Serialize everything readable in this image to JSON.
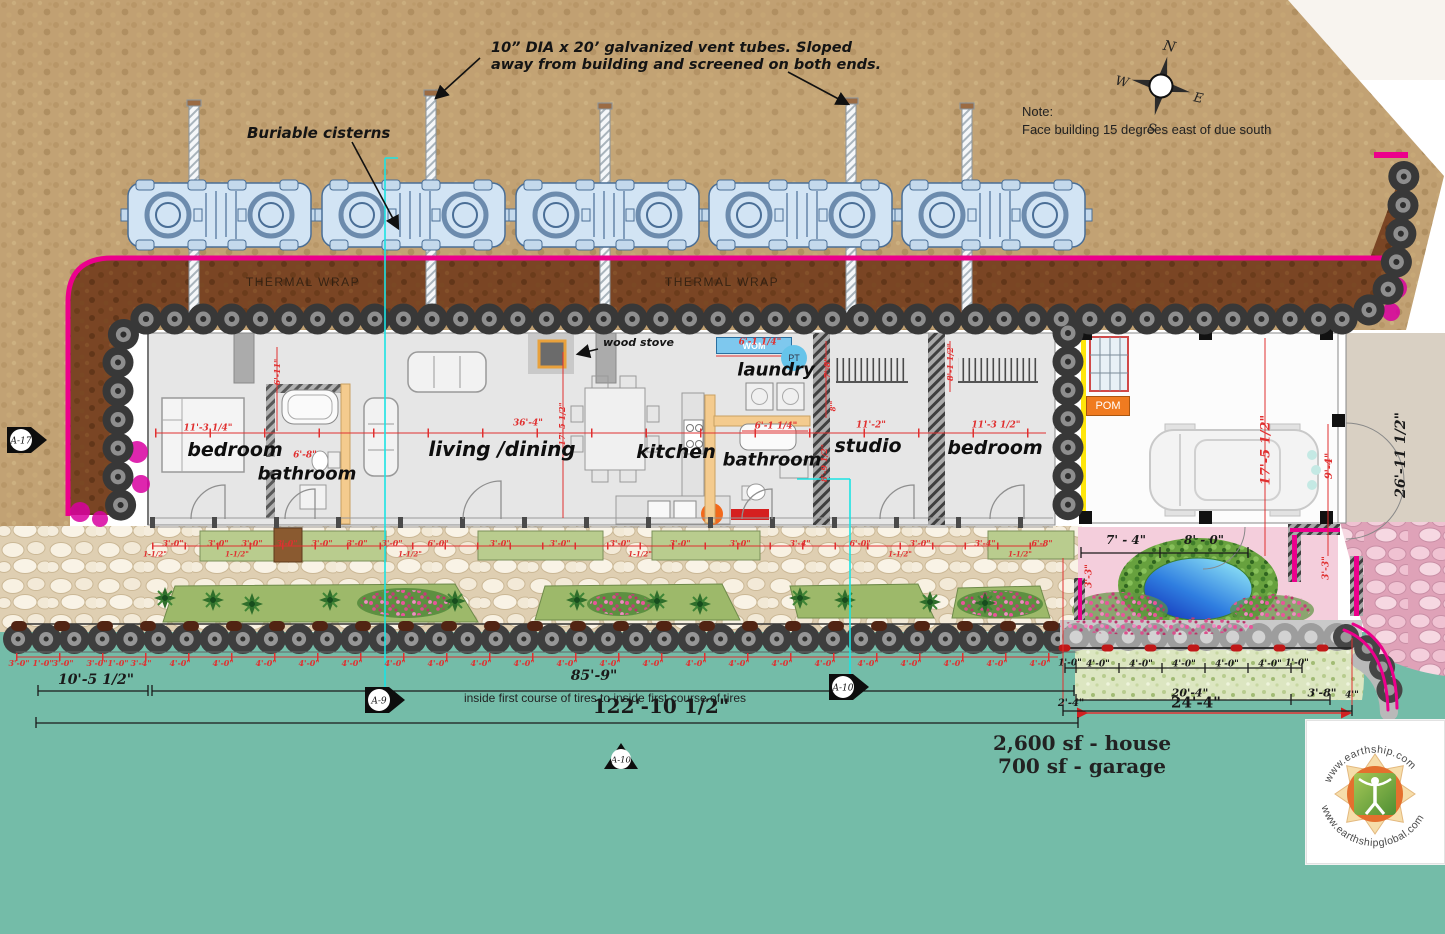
{
  "annotations": {
    "vent_note_1": "10” DIA x 20’ galvanized vent tubes. Sloped",
    "vent_note_2": "away from building and screened on both ends.",
    "buriable_cisterns": "Buriable cisterns",
    "note_title": "Note:",
    "note_body": "Face building 15 degrees east of due south",
    "thermal_wrap": "THERMAL WRAP",
    "wood_stove": "wood stove",
    "inside_tires": "inside first course of tires to inside first course of tires",
    "area_house": "2,600 sf - house",
    "area_garage": "700 sf - garage"
  },
  "compass": {
    "n": "N",
    "e": "E",
    "s": "S",
    "w": "W"
  },
  "equipment": {
    "wom": "WOM",
    "pt": "PT",
    "pom": "POM"
  },
  "logo": {
    "top": "www.earthship.com",
    "bottom": "www.earthshipglobal.com"
  },
  "markers": [
    {
      "t": "A-17"
    },
    {
      "t": "A-9"
    },
    {
      "t": "A-10"
    },
    {
      "t": "A-10"
    }
  ],
  "rooms": [
    {
      "t": "bedroom",
      "x": 235,
      "y": 450,
      "s": 19
    },
    {
      "t": "bathroom",
      "x": 307,
      "y": 474,
      "s": 18
    },
    {
      "t": "living /dining",
      "x": 502,
      "y": 449,
      "s": 20
    },
    {
      "t": "kitchen",
      "x": 676,
      "y": 452,
      "s": 19
    },
    {
      "t": "laundry",
      "x": 776,
      "y": 370,
      "s": 18
    },
    {
      "t": "bathroom",
      "x": 772,
      "y": 460,
      "s": 18
    },
    {
      "t": "studio",
      "x": 868,
      "y": 446,
      "s": 19
    },
    {
      "t": "bedroom",
      "x": 995,
      "y": 448,
      "s": 19
    }
  ],
  "dims_red": [
    {
      "t": "11'-3 1/4\"",
      "x": 208,
      "y": 429,
      "s": 9
    },
    {
      "t": "6'-11\"",
      "x": 277,
      "y": 372,
      "s": 8,
      "r": -90
    },
    {
      "t": "6'-8\"",
      "x": 305,
      "y": 456,
      "s": 9
    },
    {
      "t": "36'-4\"",
      "x": 528,
      "y": 424,
      "s": 9
    },
    {
      "t": "17'-5 1/2\"",
      "x": 562,
      "y": 424,
      "s": 8,
      "r": -90
    },
    {
      "t": "6'-1 1/4\"",
      "x": 760,
      "y": 343,
      "s": 9
    },
    {
      "t": "6'-1 1/4\"",
      "x": 776,
      "y": 427,
      "s": 9
    },
    {
      "t": "7'-8\"",
      "x": 827,
      "y": 368,
      "s": 8,
      "r": -90
    },
    {
      "t": "8'\"",
      "x": 833,
      "y": 406,
      "s": 7,
      "r": -90
    },
    {
      "t": "8'-9 1/2\"",
      "x": 824,
      "y": 463,
      "s": 8,
      "r": -90
    },
    {
      "t": "11'-2\"",
      "x": 871,
      "y": 426,
      "s": 9
    },
    {
      "t": "8'-1 1/2\"",
      "x": 950,
      "y": 362,
      "s": 8,
      "r": -90
    },
    {
      "t": "11'-3 1/2\"",
      "x": 996,
      "y": 426,
      "s": 9
    },
    {
      "t": "17'-5 1/2\"",
      "x": 1266,
      "y": 450,
      "s": 13,
      "r": -90
    },
    {
      "t": "9'-4\"",
      "x": 1330,
      "y": 466,
      "s": 10,
      "r": -90
    },
    {
      "t": "3'-3\"",
      "x": 1090,
      "y": 576,
      "s": 9,
      "r": -90
    },
    {
      "t": "3'-3\"",
      "x": 1327,
      "y": 568,
      "s": 9,
      "r": -90
    },
    {
      "t": "3'-0\"",
      "x": 173,
      "y": 543,
      "s": 8
    },
    {
      "t": "3'-0\"",
      "x": 218,
      "y": 543,
      "s": 8
    },
    {
      "t": "3'-0\"",
      "x": 252,
      "y": 543,
      "s": 8
    },
    {
      "t": "3'-0\"",
      "x": 287,
      "y": 543,
      "s": 8
    },
    {
      "t": "3'-0\"",
      "x": 322,
      "y": 543,
      "s": 8
    },
    {
      "t": "3'-0\"",
      "x": 357,
      "y": 543,
      "s": 8
    },
    {
      "t": "3'-0\"",
      "x": 392,
      "y": 543,
      "s": 8
    },
    {
      "t": "6'-0\"",
      "x": 438,
      "y": 543,
      "s": 8
    },
    {
      "t": "3'-0\"",
      "x": 500,
      "y": 543,
      "s": 8
    },
    {
      "t": "3'-0\"",
      "x": 560,
      "y": 543,
      "s": 8
    },
    {
      "t": "3'-0\"",
      "x": 620,
      "y": 543,
      "s": 8
    },
    {
      "t": "3'-0\"",
      "x": 680,
      "y": 543,
      "s": 8
    },
    {
      "t": "3'-0\"",
      "x": 740,
      "y": 543,
      "s": 8
    },
    {
      "t": "3'-4\"",
      "x": 800,
      "y": 543,
      "s": 8
    },
    {
      "t": "6'-0\"",
      "x": 860,
      "y": 543,
      "s": 8
    },
    {
      "t": "3'-0\"",
      "x": 920,
      "y": 543,
      "s": 8
    },
    {
      "t": "3'-4\"",
      "x": 985,
      "y": 543,
      "s": 8
    },
    {
      "t": "6'-8\"",
      "x": 1042,
      "y": 543,
      "s": 8
    },
    {
      "t": "1-1/2\"",
      "x": 155,
      "y": 554,
      "s": 7
    },
    {
      "t": "1-1/2\"",
      "x": 237,
      "y": 554,
      "s": 7
    },
    {
      "t": "1-1/2\"",
      "x": 410,
      "y": 554,
      "s": 7
    },
    {
      "t": "1-1/2\"",
      "x": 640,
      "y": 554,
      "s": 7
    },
    {
      "t": "1-1/2\"",
      "x": 900,
      "y": 554,
      "s": 7
    },
    {
      "t": "1-1/2\"",
      "x": 1020,
      "y": 554,
      "s": 7
    },
    {
      "t": "3'-0\"",
      "x": 19,
      "y": 663,
      "s": 8
    },
    {
      "t": "1'-0\"",
      "x": 43,
      "y": 663,
      "s": 8
    },
    {
      "t": "3'-0\"",
      "x": 63,
      "y": 663,
      "s": 8
    },
    {
      "t": "3'-0\"",
      "x": 97,
      "y": 663,
      "s": 8
    },
    {
      "t": "1'-0\"",
      "x": 118,
      "y": 663,
      "s": 8
    },
    {
      "t": "3'-4\"",
      "x": 141,
      "y": 663,
      "s": 8
    },
    {
      "t": "4'-0\"",
      "x": 180,
      "y": 663,
      "s": 8
    },
    {
      "t": "4'-0\"",
      "x": 223,
      "y": 663,
      "s": 8
    },
    {
      "t": "4'-0\"",
      "x": 266,
      "y": 663,
      "s": 8
    },
    {
      "t": "4'-0\"",
      "x": 309,
      "y": 663,
      "s": 8
    },
    {
      "t": "4'-0\"",
      "x": 352,
      "y": 663,
      "s": 8
    },
    {
      "t": "4'-0\"",
      "x": 395,
      "y": 663,
      "s": 8
    },
    {
      "t": "4'-0\"",
      "x": 438,
      "y": 663,
      "s": 8
    },
    {
      "t": "4'-0\"",
      "x": 481,
      "y": 663,
      "s": 8
    },
    {
      "t": "4'-0\"",
      "x": 524,
      "y": 663,
      "s": 8
    },
    {
      "t": "4'-0\"",
      "x": 567,
      "y": 663,
      "s": 8
    },
    {
      "t": "4'-0\"",
      "x": 610,
      "y": 663,
      "s": 8
    },
    {
      "t": "4'-0\"",
      "x": 653,
      "y": 663,
      "s": 8
    },
    {
      "t": "4'-0\"",
      "x": 696,
      "y": 663,
      "s": 8
    },
    {
      "t": "4'-0\"",
      "x": 739,
      "y": 663,
      "s": 8
    },
    {
      "t": "4'-0\"",
      "x": 782,
      "y": 663,
      "s": 8
    },
    {
      "t": "4'-0\"",
      "x": 825,
      "y": 663,
      "s": 8
    },
    {
      "t": "4'-0\"",
      "x": 868,
      "y": 663,
      "s": 8
    },
    {
      "t": "4'-0\"",
      "x": 911,
      "y": 663,
      "s": 8
    },
    {
      "t": "4'-0\"",
      "x": 954,
      "y": 663,
      "s": 8
    },
    {
      "t": "4'-0\"",
      "x": 997,
      "y": 663,
      "s": 8
    },
    {
      "t": "4'-0\"",
      "x": 1040,
      "y": 663,
      "s": 8
    }
  ],
  "dims_black": [
    {
      "t": "10'-5 1/2\"",
      "x": 96,
      "y": 680,
      "s": 14
    },
    {
      "t": "85'-9\"",
      "x": 594,
      "y": 676,
      "s": 14
    },
    {
      "t": "7' - 4\"",
      "x": 1126,
      "y": 540,
      "s": 12
    },
    {
      "t": "8' - 0\"",
      "x": 1204,
      "y": 540,
      "s": 12
    },
    {
      "t": "20'-4\"",
      "x": 1190,
      "y": 693,
      "s": 11
    },
    {
      "t": "3'-8\"",
      "x": 1322,
      "y": 693,
      "s": 11
    },
    {
      "t": "2'-4\"",
      "x": 1071,
      "y": 704,
      "s": 10
    },
    {
      "t": "4'\"",
      "x": 1352,
      "y": 696,
      "s": 9
    },
    {
      "t": "26'-11 1/2\"",
      "x": 1401,
      "y": 455,
      "s": 14,
      "r": -90
    },
    {
      "t": "1'-0\"",
      "x": 1070,
      "y": 664,
      "s": 9
    },
    {
      "t": "4'-0\"",
      "x": 1098,
      "y": 665,
      "s": 9
    },
    {
      "t": "4'-0\"",
      "x": 1141,
      "y": 665,
      "s": 9
    },
    {
      "t": "4'-0\"",
      "x": 1184,
      "y": 665,
      "s": 9
    },
    {
      "t": "4'-0\"",
      "x": 1227,
      "y": 665,
      "s": 9
    },
    {
      "t": "4'-0\"",
      "x": 1270,
      "y": 665,
      "s": 9
    },
    {
      "t": "1'-0\"",
      "x": 1297,
      "y": 664,
      "s": 9
    }
  ],
  "dims_big": [
    {
      "t": "122'-10 1/2\"",
      "x": 661,
      "y": 706,
      "s": 20
    },
    {
      "t": "24'-4\"",
      "x": 1196,
      "y": 703,
      "s": 15
    }
  ]
}
